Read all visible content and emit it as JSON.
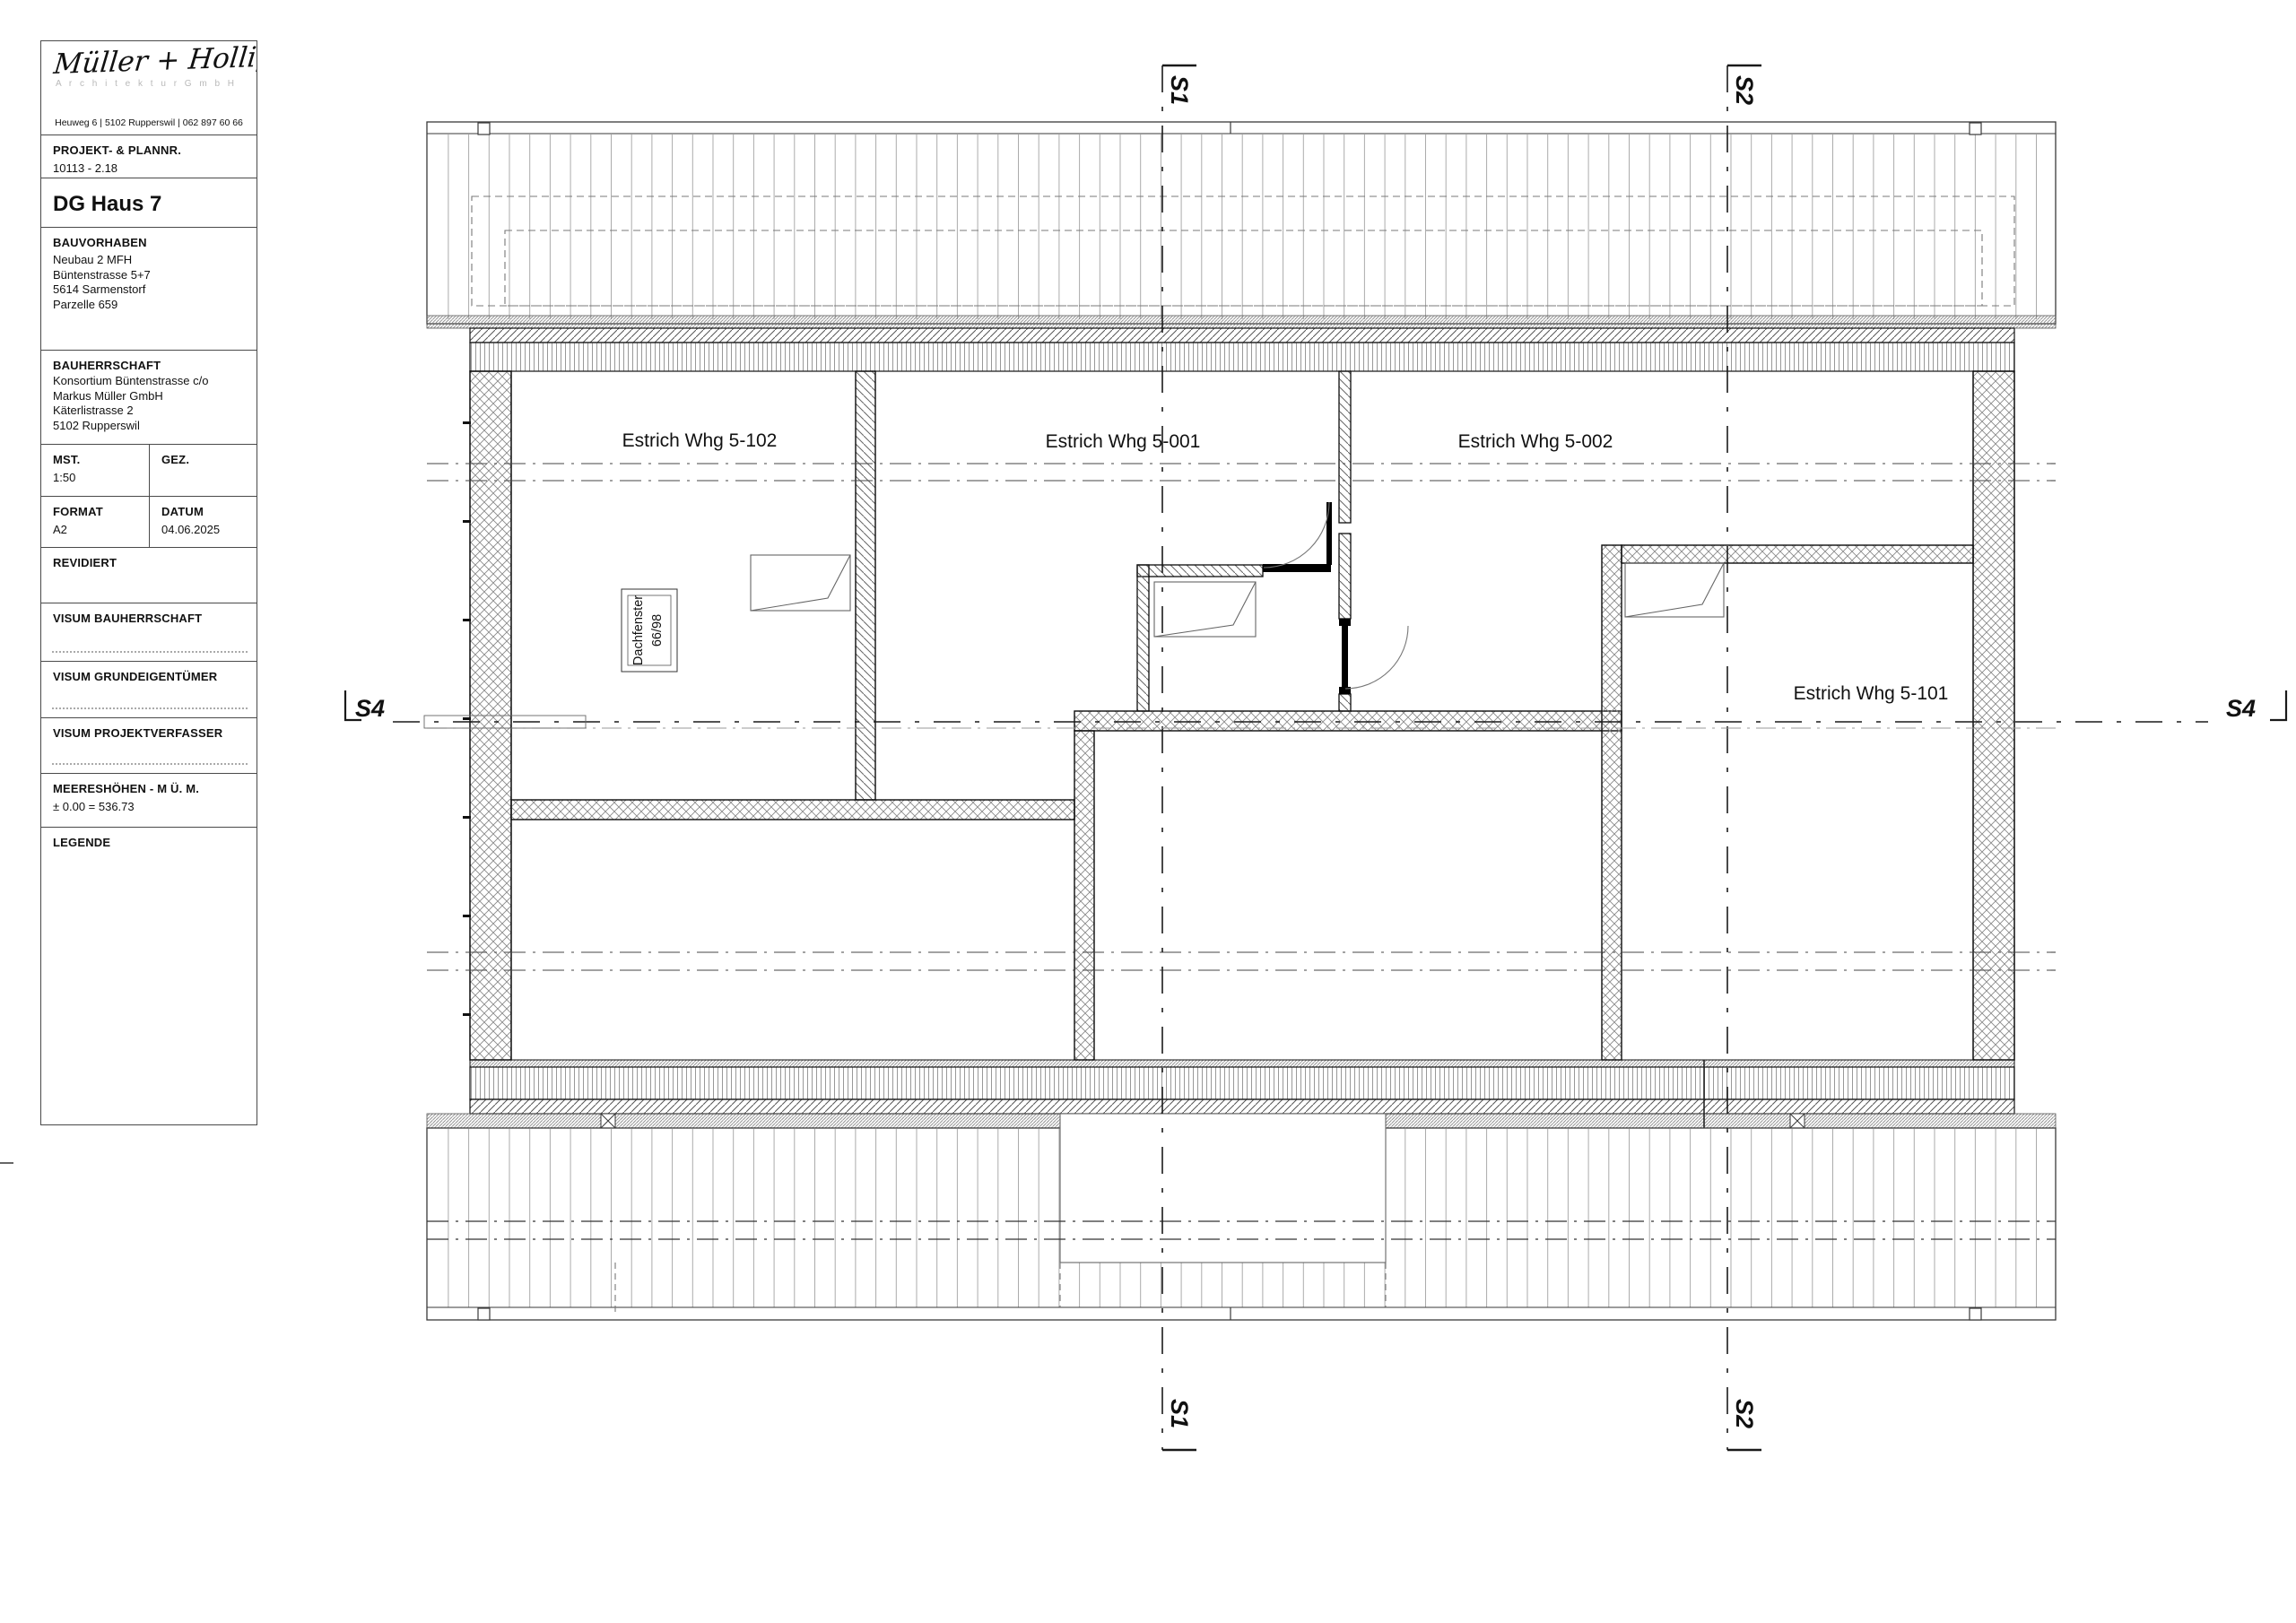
{
  "title_block": {
    "logo_name": "Müller + Holliger",
    "logo_subtitle": "A r c h i t e k t u r   G m b H",
    "logo_address": "Heuweg 6 | 5102 Rupperswil | 062 897 60 66",
    "project_number_label": "PROJEKT- & PLANNR.",
    "project_number_value": "10113 - 2.18",
    "plan_title": "DG Haus 7",
    "bauvorhaben_label": "BAUVORHABEN",
    "bauvorhaben_lines": [
      "Neubau 2 MFH",
      "Büntenstrasse 5+7",
      "5614 Sarmenstorf",
      "Parzelle 659"
    ],
    "bauherrschaft_label": "BAUHERRSCHAFT",
    "bauherrschaft_lines": [
      "Konsortium Büntenstrasse c/o",
      "Markus Müller GmbH",
      "Käterlistrasse 2",
      "5102 Rupperswil"
    ],
    "mst_label": "MST.",
    "mst_value": "1:50",
    "gez_label": "GEZ.",
    "format_label": "FORMAT",
    "format_value": "A2",
    "datum_label": "DATUM",
    "datum_value": "04.06.2025",
    "revidiert_label": "REVIDIERT",
    "visum_bauherrschaft_label": "VISUM BAUHERRSCHAFT",
    "visum_grundeigentuemer_label": "VISUM GRUNDEIGENTÜMER",
    "visum_projektverfasser_label": "VISUM PROJEKTVERFASSER",
    "meereshoehen_label": "MEERESHÖHEN - M Ü. M.",
    "meereshoehen_value": "± 0.00 = 536.73",
    "legende_label": "LEGENDE"
  },
  "plan": {
    "rooms": [
      "Estrich Whg 5-102",
      "Estrich Whg 5-001",
      "Estrich Whg 5-002",
      "Estrich Whg 5-101"
    ],
    "skylight_label_line1": "Dachfenster",
    "skylight_label_line2": "66/98",
    "section_s1": "S1",
    "section_s2": "S2",
    "section_s4": "S4"
  }
}
